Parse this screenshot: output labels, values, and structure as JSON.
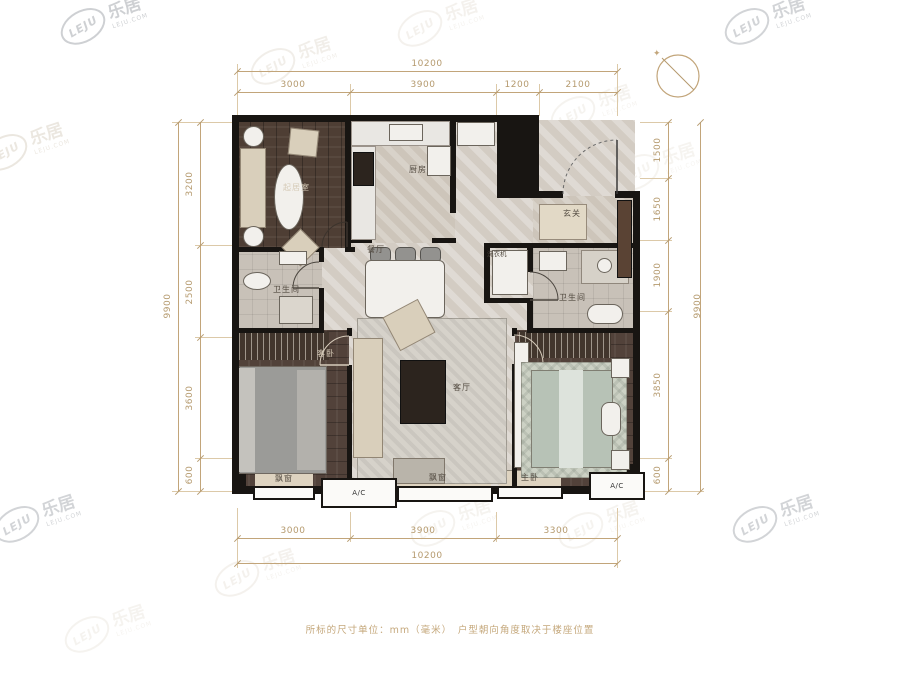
{
  "brand": {
    "logo_text": "LEJU",
    "brand_cn": "乐居",
    "brand_domain": "LEJU.COM"
  },
  "compass": {
    "north_marker": "✦"
  },
  "dims": {
    "top_total": "10200",
    "top_segments": [
      "3000",
      "3900",
      "1200",
      "2100"
    ],
    "left_total": "9900",
    "left_segments": [
      "3200",
      "2500",
      "3600",
      "600"
    ],
    "right_total": "9900",
    "right_segments": [
      "1500",
      "1650",
      "1900",
      "3850",
      "600"
    ],
    "bottom_total": "10200",
    "bottom_segments": [
      "3000",
      "3900",
      "3300"
    ]
  },
  "rooms": {
    "sitting": "起居室",
    "kitchen": "厨房",
    "entry": "玄关",
    "dining": "餐厅",
    "laundry": "洗衣机",
    "bath_left": "卫生间",
    "bath_right": "卫生间",
    "guest_bedroom": "客卧",
    "living": "客厅",
    "master_bedroom": "主卧",
    "bay_left": "飘窗",
    "bay_center": "飘窗",
    "ac_left": "A/C",
    "ac_right": "A/C"
  },
  "footer": {
    "note": "所标的尺寸单位：mm（毫米）　户型朝向角度取决于楼座位置"
  }
}
